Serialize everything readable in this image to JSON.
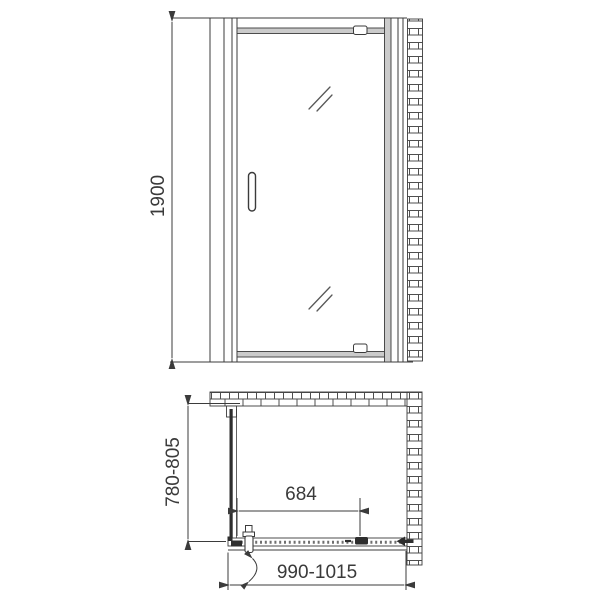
{
  "drawing": {
    "type": "technical-drawing",
    "subject": "pivot-shower-door-with-side-panel",
    "views": {
      "front_elevation": {
        "name": "front-elevation",
        "height_dimension": {
          "label": "1900",
          "orientation": "vertical"
        }
      },
      "plan": {
        "name": "plan-view",
        "depth_dimension": {
          "label": "780-805",
          "orientation": "vertical"
        },
        "opening_dimension": {
          "label": "684",
          "orientation": "horizontal"
        },
        "width_dimension": {
          "label": "990-1015",
          "orientation": "horizontal"
        }
      }
    },
    "colors": {
      "line": "#3b3b3b",
      "text": "#3a3a3a",
      "frame_fill": "#cbcbcb",
      "brick_mortar": "#4f4f4f",
      "brick_fill": "#ffffff",
      "background": "#ffffff"
    }
  }
}
